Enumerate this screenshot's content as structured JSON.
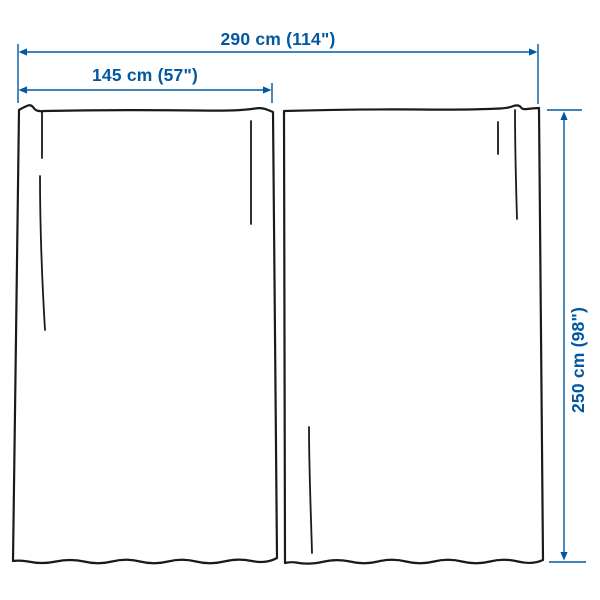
{
  "diagram": {
    "kind": "product-dimension-diagram",
    "subject": "two curtain panels",
    "colors": {
      "dimension_accent": "#0058A3",
      "outline": "#1a1a1a",
      "background": "#ffffff"
    },
    "labels": {
      "total_width": "290 cm (114\")",
      "panel_width": "145 cm (57\")",
      "panel_height": "250 cm (98\")"
    }
  }
}
